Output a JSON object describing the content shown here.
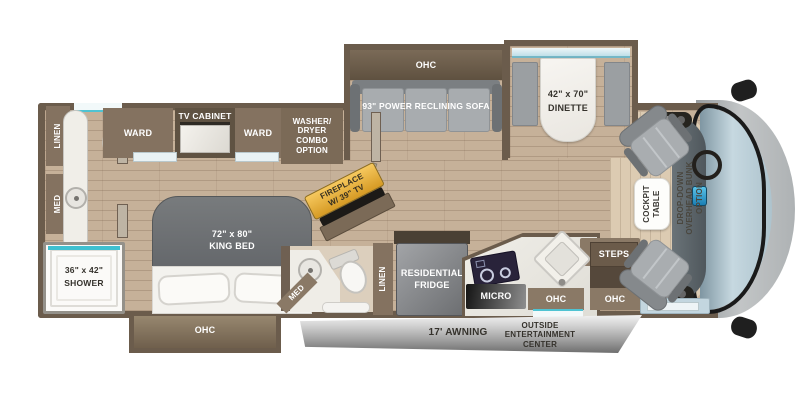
{
  "colors": {
    "wall_brown": "#6b5c4c",
    "cabinet_brown": "#847260",
    "floor_tan": "#c6b199",
    "upholstery_gray": "#a9adb0",
    "accent_teal": "#4fc3d2",
    "fireplace_amber": "#e8ab38",
    "awning_gray": "#9a9a9a",
    "cap_gray": "#b5b7b8",
    "windshield_blue": "#c6d8e0"
  },
  "rooms": {
    "bathroom_rear": {
      "linen": "LINEN",
      "med": "MED",
      "shower_size": "36\" x 42\"",
      "shower": "SHOWER"
    },
    "bedroom": {
      "ward_left": "WARD",
      "tv_cabinet": "TV CABINET",
      "ward_right": "WARD",
      "washer_l1": "WASHER/",
      "washer_l2": "DRYER",
      "washer_l3": "COMBO",
      "washer_l4": "OPTION",
      "bed_size": "72\" x 80\"",
      "bed_name": "KING BED",
      "bed_ohc": "OHC"
    },
    "living": {
      "sofa_ohc": "OHC",
      "sofa": "93\" POWER RECLINING SOFA",
      "dinette_size": "42\" x 70\"",
      "dinette": "DINETTE",
      "fireplace_l1": "FIREPLACE",
      "fireplace_l2": "W/ 39\" TV"
    },
    "bathroom_mid": {
      "med": "MED",
      "linen": "LINEN"
    },
    "kitchen": {
      "fridge_l1": "RESIDENTIAL",
      "fridge_l2": "FRIDGE",
      "micro": "MICRO",
      "ohc_1": "OHC",
      "ohc_2": "OHC",
      "steps": "STEPS"
    },
    "cockpit": {
      "table_l1": "COCKPIT",
      "table_l2": "TABLE",
      "bunk_l1": "DROP-DOWN",
      "bunk_l2": "OVERHEAD BUNK",
      "bunk_l3": "OPTION"
    },
    "exterior": {
      "awning": "17' AWNING",
      "outside_l1": "OUTSIDE",
      "outside_l2": "ENTERTAINMENT",
      "outside_l3": "CENTER"
    }
  }
}
